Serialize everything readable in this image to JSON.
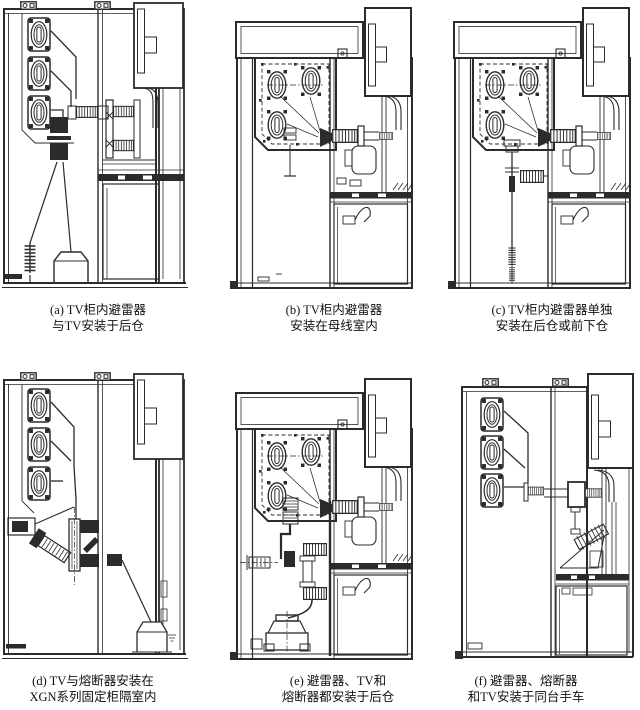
{
  "page": {
    "background": "#ffffff",
    "line_color": "#2b2b2b",
    "text_color": "#111111"
  },
  "figures": [
    {
      "id": "a",
      "caption_line1": "(a) TV柜内避雷器",
      "caption_line2": "与TV安装于后仓"
    },
    {
      "id": "b",
      "caption_line1": "(b) TV柜内避雷器",
      "caption_line2": "安装在母线室内"
    },
    {
      "id": "c",
      "caption_line1": "(c) TV柜内避雷器单独",
      "caption_line2": "安装在后仓或前下仓"
    },
    {
      "id": "d",
      "caption_line1": "(d) TV与熔断器安装在",
      "caption_line2": "XGN系列固定柜隔室内"
    },
    {
      "id": "e",
      "caption_line1": "(e) 避雷器、TV和",
      "caption_line2": "熔断器都安装于后仓"
    },
    {
      "id": "f",
      "caption_line1": "(f) 避雷器、熔断器",
      "caption_line2": "和TV安装于同台手车"
    }
  ]
}
